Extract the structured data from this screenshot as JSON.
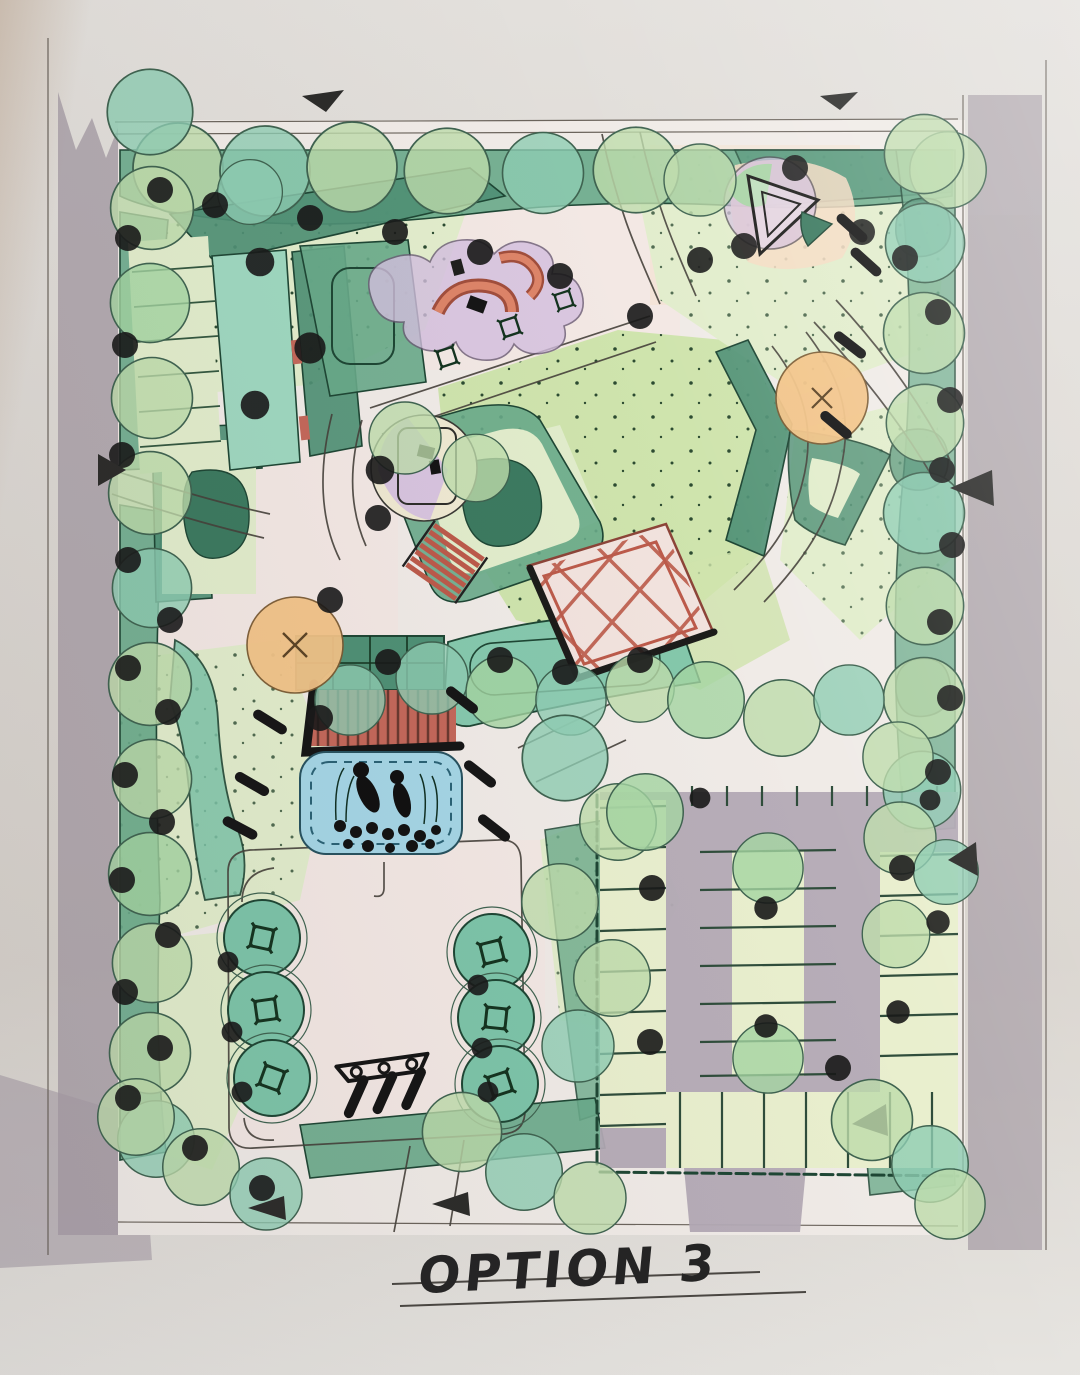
{
  "page": {
    "title_label": "OPTION 3",
    "description": "hand-drawn watercolor landscape site plan, top view"
  },
  "palette": {
    "paper": "#dedad5",
    "paperWarm": "#cfc1b3",
    "road": "#a79da6",
    "asphalt": "#b3aab5",
    "ground": "#f0ebe7",
    "pink": "#f5e6e2",
    "lawn": "#cfe4ad",
    "lawnPale": "#e2edcc",
    "stallBed": "#e9efce",
    "treeLight": "#bedcab",
    "treeTeal": "#8ecdb3",
    "treeMid": "#a5d6a2",
    "hedgeDark": "#4f9075",
    "hedgeMid": "#68aa8a",
    "hedgeTeal": "#7dc5a9",
    "deepGreen": "#3c7a60",
    "ink": "#1f1f1f",
    "outlineGreen": "#1e4634",
    "pool": "#a5d6e6",
    "deckRed": "#c4685a",
    "lattice": "#bc5a4a",
    "purple": "#d5c0e0",
    "coral": "#dd8468",
    "orange": "#f3c488",
    "peach": "#f6dcc3",
    "pathLine": "#45403a"
  }
}
